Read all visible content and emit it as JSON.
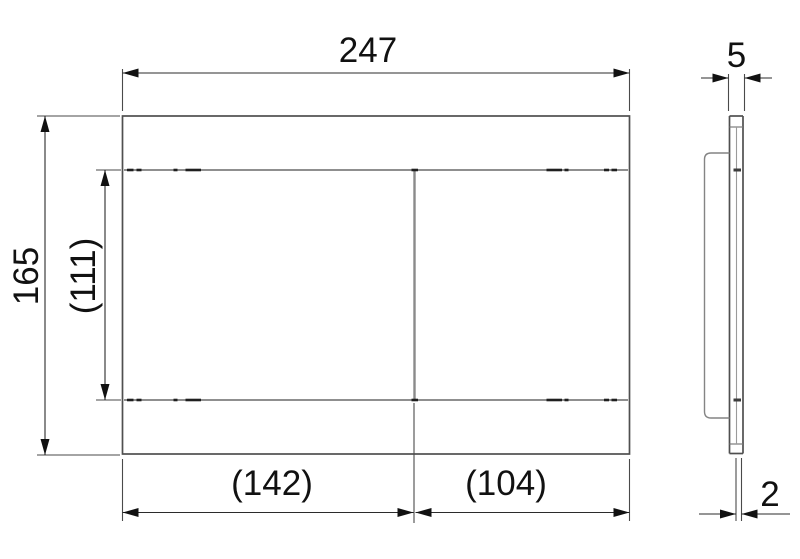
{
  "drawing": {
    "type": "technical-dimension-drawing",
    "views": {
      "front": {
        "overall_width": "247",
        "overall_height": "165",
        "buttons_height": "(111)",
        "large_button_width": "(142)",
        "small_button_width": "(104)"
      },
      "side": {
        "plate_thickness": "5",
        "button_protrusion": "2"
      }
    },
    "colors": {
      "background": "#ffffff",
      "ink": "#111111",
      "outline": "#4f4f4f",
      "light_line": "#8f8f8f"
    }
  }
}
